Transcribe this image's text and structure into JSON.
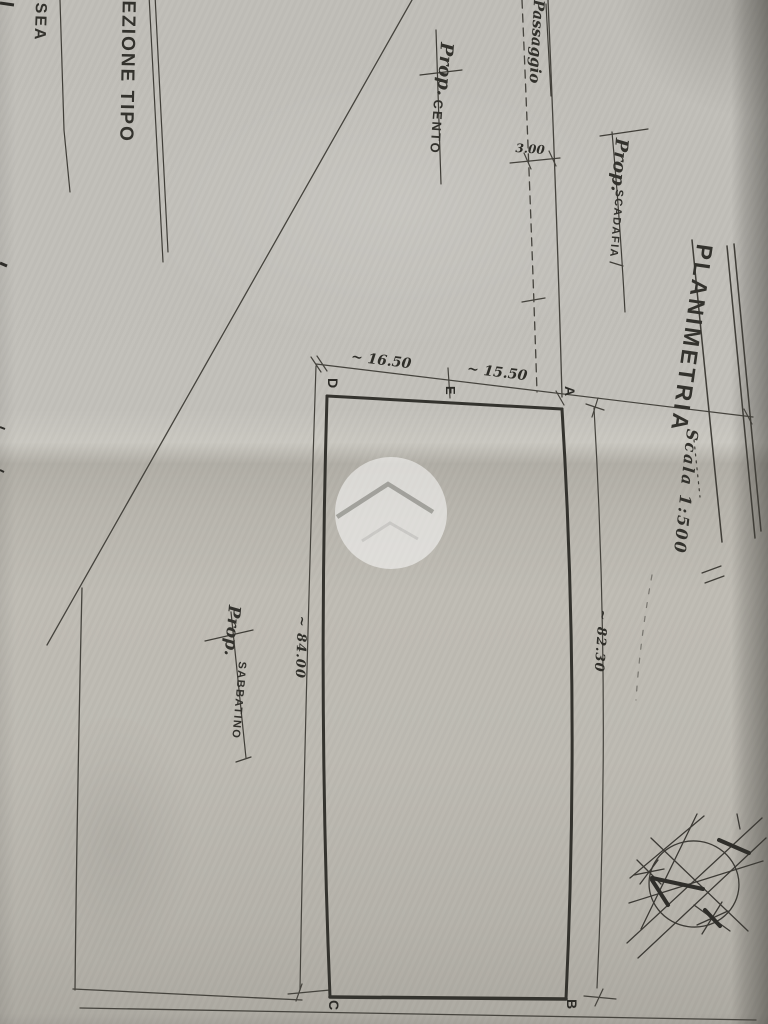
{
  "title": {
    "main": "PLANIMETRIA",
    "scale": "Scala 1:500"
  },
  "corner_texts": {
    "section_type": "SEZIONE TIPO",
    "edge_fragment": "SEA"
  },
  "owners": {
    "cento": {
      "prefix": "Prop.",
      "name": "CENTO"
    },
    "scadafia": {
      "prefix": "Prop.",
      "name": "SCADAFIA"
    },
    "sabbatino": {
      "prefix": "Prop.",
      "name": "SABBATINO"
    }
  },
  "passage": {
    "label": "Passaggio",
    "width_dim": "3.00"
  },
  "dimensions": {
    "top_left_segment": "~ 16.50",
    "top_right_segment": "~ 15.50",
    "left_side": "~ 84.00",
    "right_side": "~ 82.30"
  },
  "points": {
    "a": "A",
    "b": "B",
    "c": "C",
    "d": "D",
    "e": "E"
  },
  "symbols": {
    "north_indicator": "compass-rose",
    "watermark": "house-chevron-watermark"
  },
  "colors": {
    "ink": "#3b3a35",
    "ink_thick": "#34332e",
    "paper": "#bdbab2",
    "watermark": "#ffffff"
  }
}
